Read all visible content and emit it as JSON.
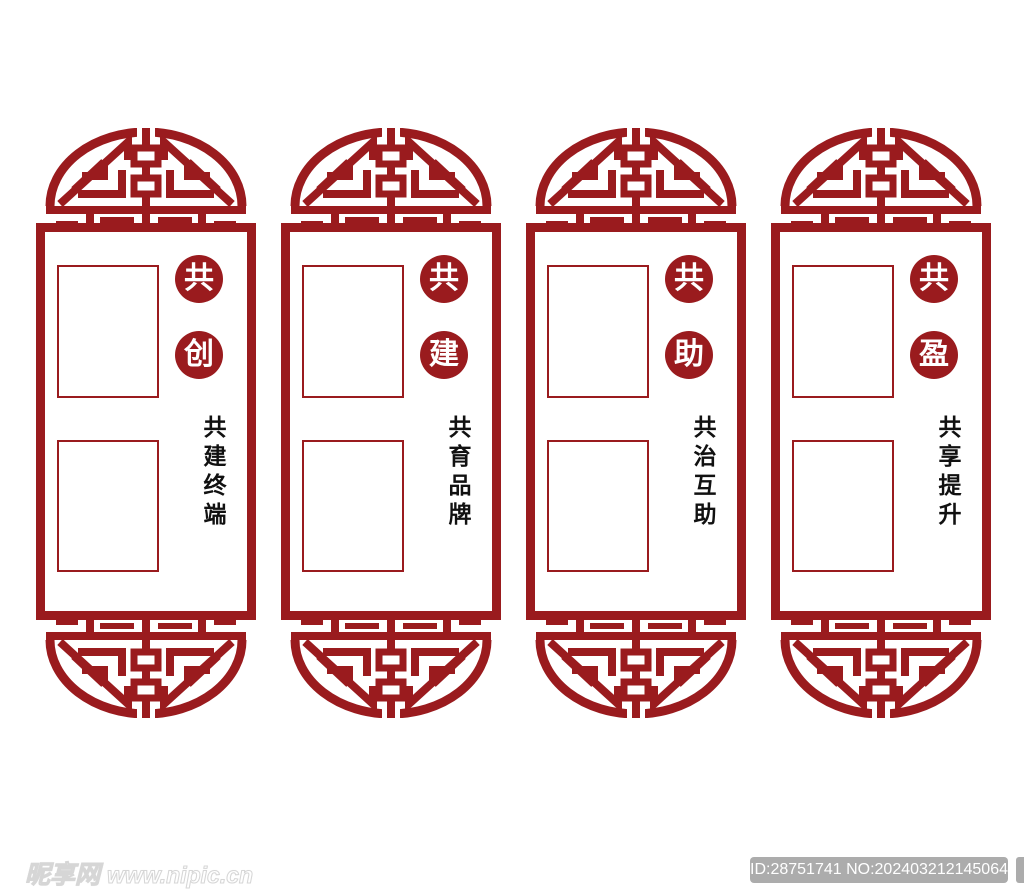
{
  "colors": {
    "lattice_red": "#9a1b1e",
    "tagline_black": "#111111",
    "watermark_gray": "#acacac"
  },
  "panels": [
    {
      "seal_chars": [
        "共",
        "创"
      ],
      "tagline": "共建终端"
    },
    {
      "seal_chars": [
        "共",
        "建"
      ],
      "tagline": "共育品牌"
    },
    {
      "seal_chars": [
        "共",
        "助"
      ],
      "tagline": "共治互助"
    },
    {
      "seal_chars": [
        "共",
        "盈"
      ],
      "tagline": "共享提升"
    }
  ],
  "watermark": {
    "site_name": "昵享网",
    "site_url": "www.nipic.cn",
    "id_text": "ID:28751741 NO:20240321214506417101"
  }
}
